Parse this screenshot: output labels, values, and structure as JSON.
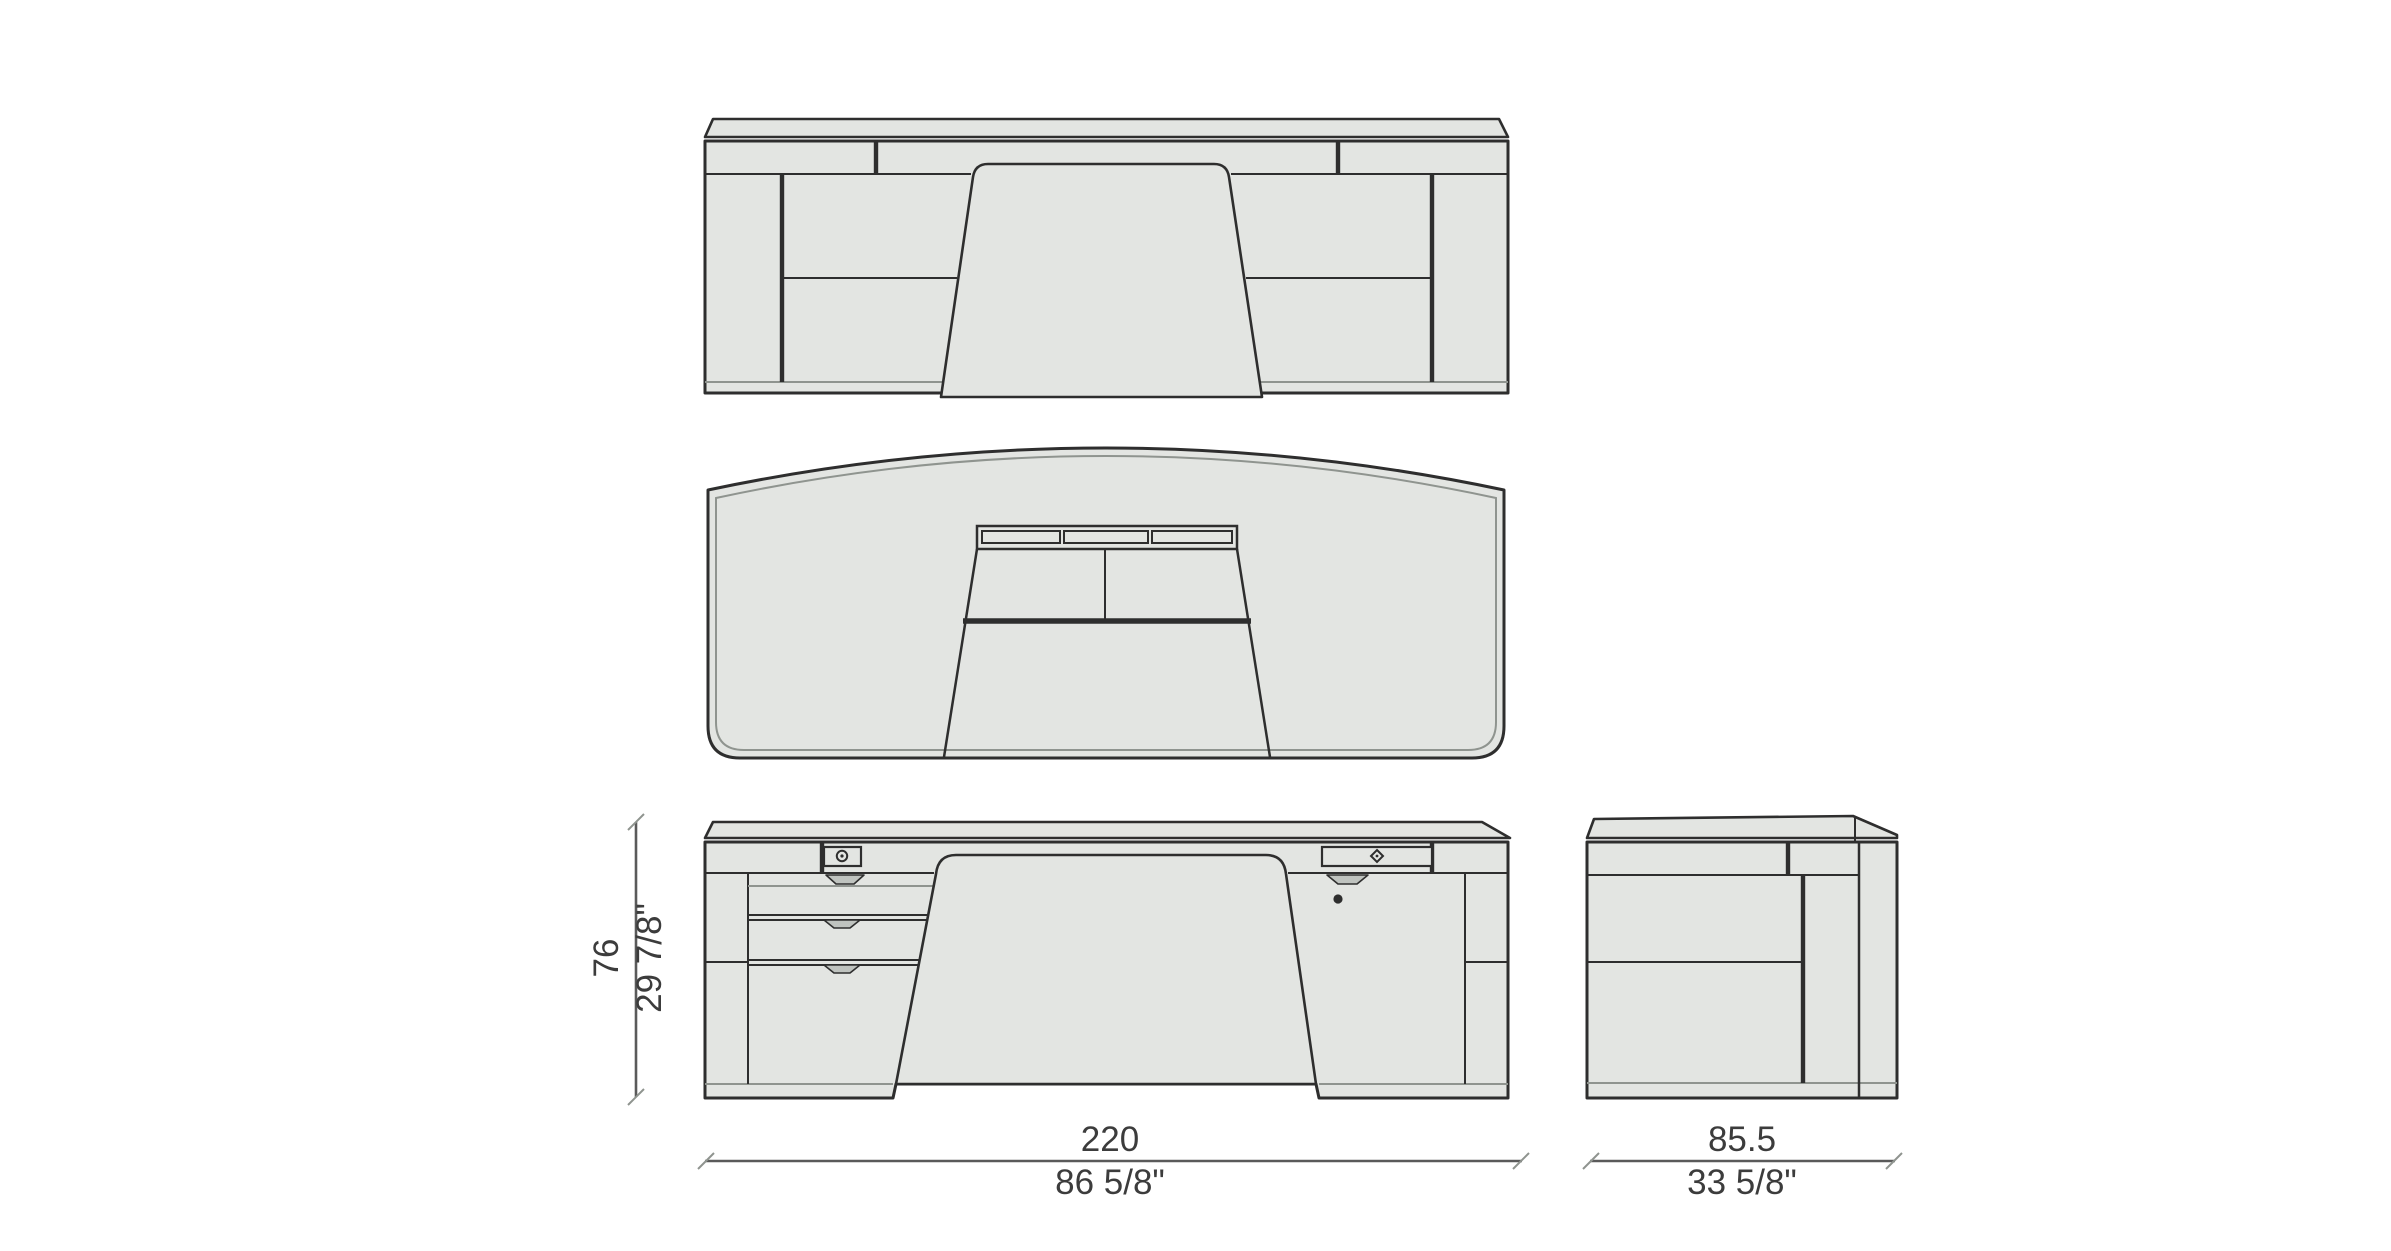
{
  "drawing": {
    "dimensions": {
      "height": {
        "metric": "76",
        "imperial": "29 7/8\""
      },
      "width": {
        "metric": "220",
        "imperial": "86 5/8\""
      },
      "depth": {
        "metric": "85.5",
        "imperial": "33 5/8\""
      }
    },
    "colors": {
      "background": "#ffffff",
      "panel_fill": "#e3e5e2",
      "notch_fill": "#bfc3bf",
      "line": "#2e2e2e",
      "line_light": "#8f948f",
      "dim_line": "#5a5a5a",
      "dim_text": "#3c3c3c"
    }
  }
}
